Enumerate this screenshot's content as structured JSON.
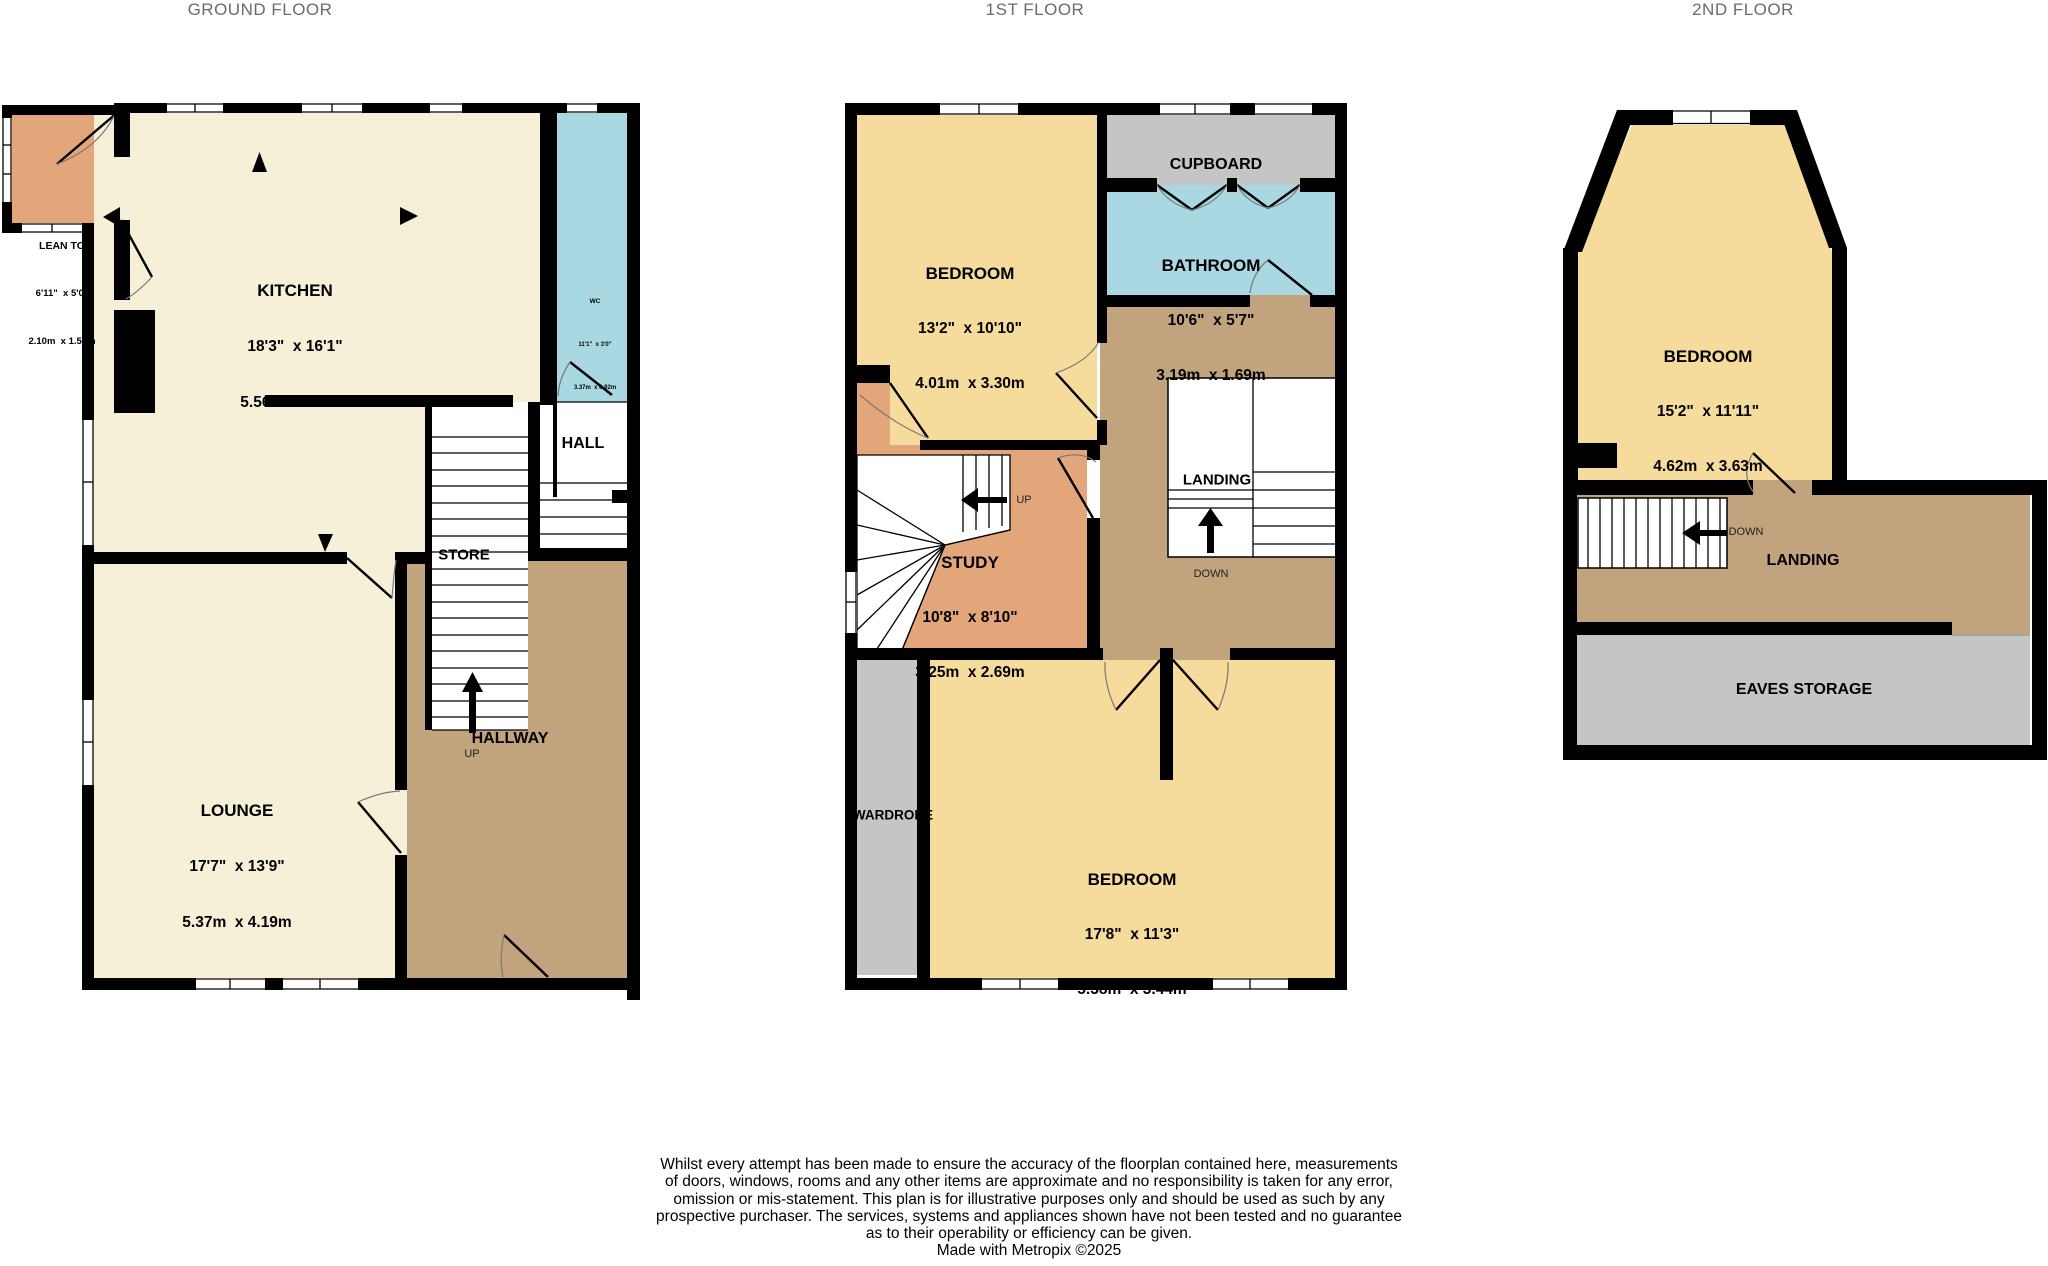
{
  "titles": {
    "ground": "GROUND FLOOR",
    "first": "1ST FLOOR",
    "second": "2ND FLOOR"
  },
  "ground_floor": {
    "lean_to": {
      "name": "LEAN TO",
      "imperial": "6'11\"  x 5'0\"",
      "metric": "2.10m  x 1.52m"
    },
    "kitchen": {
      "name": "KITCHEN",
      "imperial": "18'3\"  x 16'1\"",
      "metric": "5.56m  x 4.91m"
    },
    "wc": {
      "name": "WC",
      "imperial": "11'1\"  x 3'0\"",
      "metric": "3.37m  x 0.92m"
    },
    "hall": {
      "name": "HALL"
    },
    "store": {
      "name": "STORE"
    },
    "lounge": {
      "name": "LOUNGE",
      "imperial": "17'7\"  x 13'9\"",
      "metric": "5.37m  x 4.19m"
    },
    "hallway": {
      "name": "HALLWAY"
    },
    "stairs_up": "UP"
  },
  "first_floor": {
    "bedroom1": {
      "name": "BEDROOM",
      "imperial": "13'2\"  x 10'10\"",
      "metric": "4.01m  x 3.30m"
    },
    "cupboard": {
      "name": "CUPBOARD"
    },
    "bathroom": {
      "name": "BATHROOM",
      "imperial": "10'6\"  x 5'7\"",
      "metric": "3.19m  x 1.69m"
    },
    "landing": {
      "name": "LANDING"
    },
    "study": {
      "name": "STUDY",
      "imperial": "10'8\"  x 8'10\"",
      "metric": "3.25m  x 2.69m"
    },
    "wardrobe": {
      "name": "WARDROBE"
    },
    "bedroom2": {
      "name": "BEDROOM",
      "imperial": "17'8\"  x 11'3\"",
      "metric": "5.38m  x 3.44m"
    },
    "stairs_up": "UP",
    "stairs_down": "DOWN"
  },
  "second_floor": {
    "bedroom": {
      "name": "BEDROOM",
      "imperial": "15'2\"  x 11'11\"",
      "metric": "4.62m  x 3.63m"
    },
    "landing": {
      "name": "LANDING"
    },
    "eaves": {
      "name": "EAVES STORAGE"
    },
    "stairs_down": "DOWN"
  },
  "disclaimer": {
    "lines": [
      "Whilst every attempt has been made to ensure the accuracy of the floorplan contained here, measurements",
      "of doors, windows, rooms and any other items are approximate and no responsibility is taken for any error,",
      "omission or mis-statement. This plan is for illustrative purposes only and should be used as such by any",
      "prospective purchaser. The services, systems and appliances shown have not been tested and no guarantee",
      "as to their operability or efficiency can be given.",
      "Made with Metropix ©2025"
    ]
  },
  "colors": {
    "room_cream": "#F7F0D8",
    "room_yellow": "#F5DC9C",
    "room_orange": "#E3A67B",
    "room_blue": "#A9D7E2",
    "room_brown": "#C1A37D",
    "room_gray": "#C5C5C5",
    "wall": "#000000",
    "title_text": "#6A6B6E"
  }
}
